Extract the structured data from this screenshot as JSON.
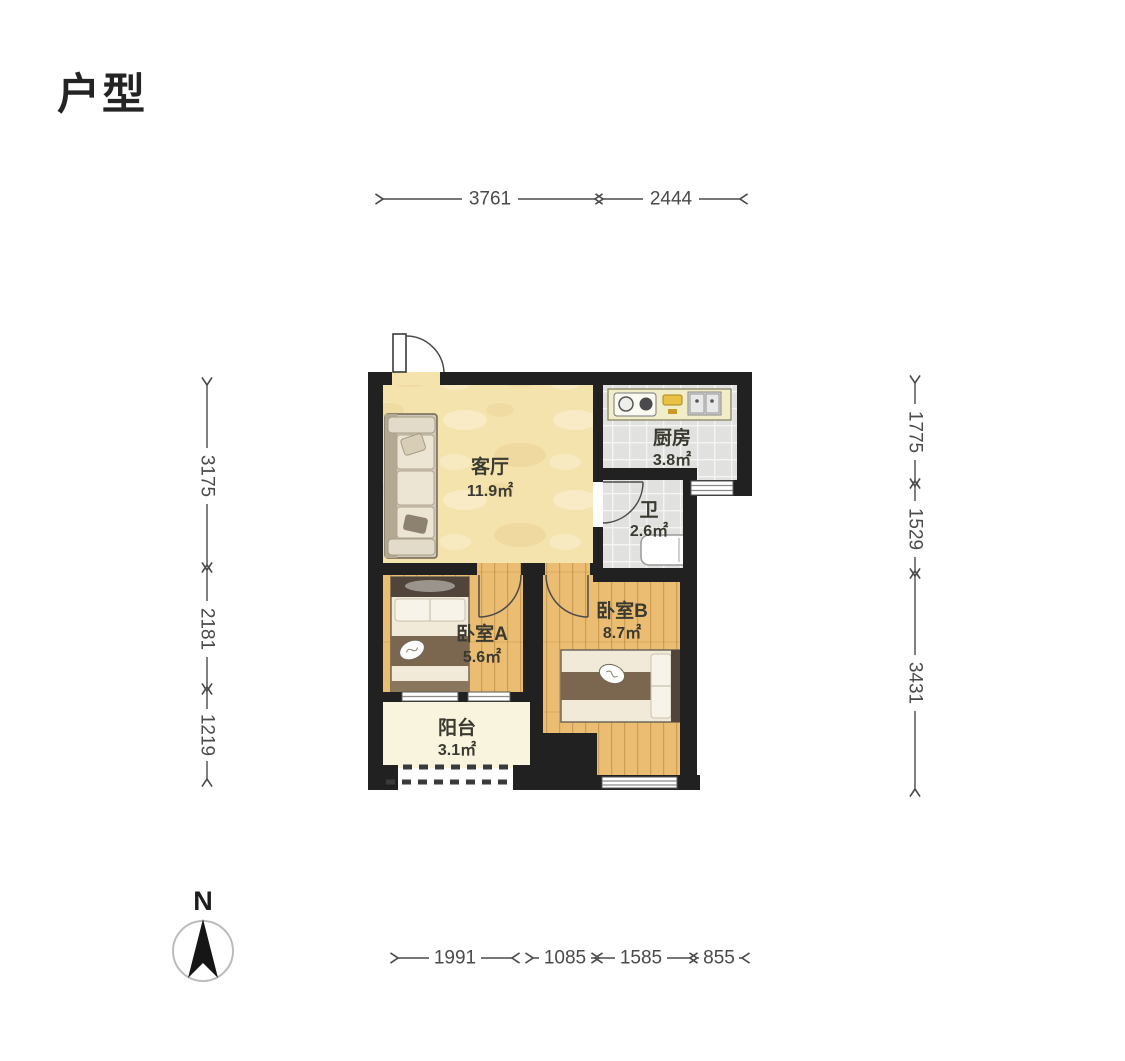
{
  "page": {
    "title": "户型"
  },
  "floorplan": {
    "rooms": {
      "living": {
        "name": "客厅",
        "area": "11.9㎡"
      },
      "kitchen": {
        "name": "厨房",
        "area": "3.8㎡"
      },
      "bath": {
        "name": "卫",
        "area": "2.6㎡"
      },
      "bedroomA": {
        "name": "卧室A",
        "area": "5.6㎡"
      },
      "bedroomB": {
        "name": "卧室B",
        "area": "8.7㎡"
      },
      "balcony": {
        "name": "阳台",
        "area": "3.1㎡"
      }
    },
    "dimensions": {
      "top": [
        "3761",
        "2444"
      ],
      "left": [
        "3175",
        "2181",
        "1219"
      ],
      "right": [
        "1775",
        "1529",
        "3431"
      ],
      "bottom": [
        "1991",
        "1085",
        "1585",
        "855"
      ]
    },
    "compass": {
      "label": "N"
    }
  },
  "colors": {
    "wall": "#212121",
    "livingFloor": "#f5e3ae",
    "woodFloor": "#eabd72",
    "tileFloor": "#e1e1df",
    "balconyFloor": "#f9f4de",
    "counter": "#f2edc9",
    "dim": "#4a4a4a",
    "label": "#3a3a31"
  }
}
